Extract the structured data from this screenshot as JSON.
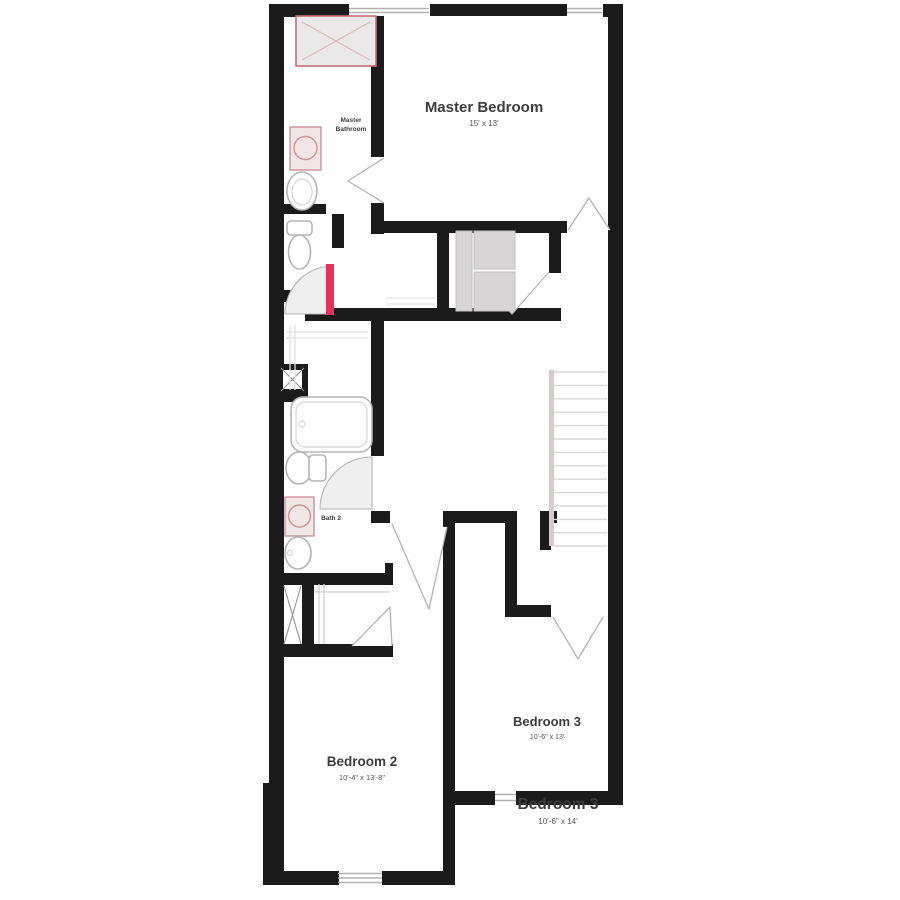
{
  "page": {
    "description": "Second-story residential floor plan, black walls on white background",
    "background": "#ffffff"
  },
  "rooms": {
    "master_bedroom": {
      "label": "Master Bedroom",
      "dims": "15' x 13'"
    },
    "master_bathroom": {
      "label_line1": "Master",
      "label_line2": "Bathroom"
    },
    "bath2": {
      "label": "Bath 2"
    },
    "bedroom2": {
      "label": "Bedroom 2",
      "dims": "10'-4\" x 13'-8\""
    },
    "bedroom3": {
      "label": "Bedroom 3",
      "dims": "10'-6\" x 13'"
    },
    "bedroom3_callout": {
      "label": "Bedroom 3",
      "dims": "10'-6\" x 14'"
    }
  },
  "fixtures": [
    "shower",
    "master-vanity-sink",
    "master-second-sink",
    "master-toilet",
    "red-swing-door",
    "walk-in-closet-shelves",
    "linen-chase",
    "bathtub",
    "bath2-toilet",
    "bath2-vanity-sink",
    "bath2-second-sink",
    "staircase",
    "bedroom2-closet",
    "windows",
    "door-swings"
  ],
  "colors": {
    "wall": "#1b1b1b",
    "door_accent": "#e8315b",
    "shower_border": "#c76e76",
    "shower_fill": "#eae8e8",
    "vanity_line": "#cb9298",
    "fixture_line": "#b5b5b5",
    "swing_line": "#b3b3b3",
    "window_line": "#b0b0b0",
    "stair_rail": "#d8c9ca",
    "label_text": "#3d3d3d"
  }
}
